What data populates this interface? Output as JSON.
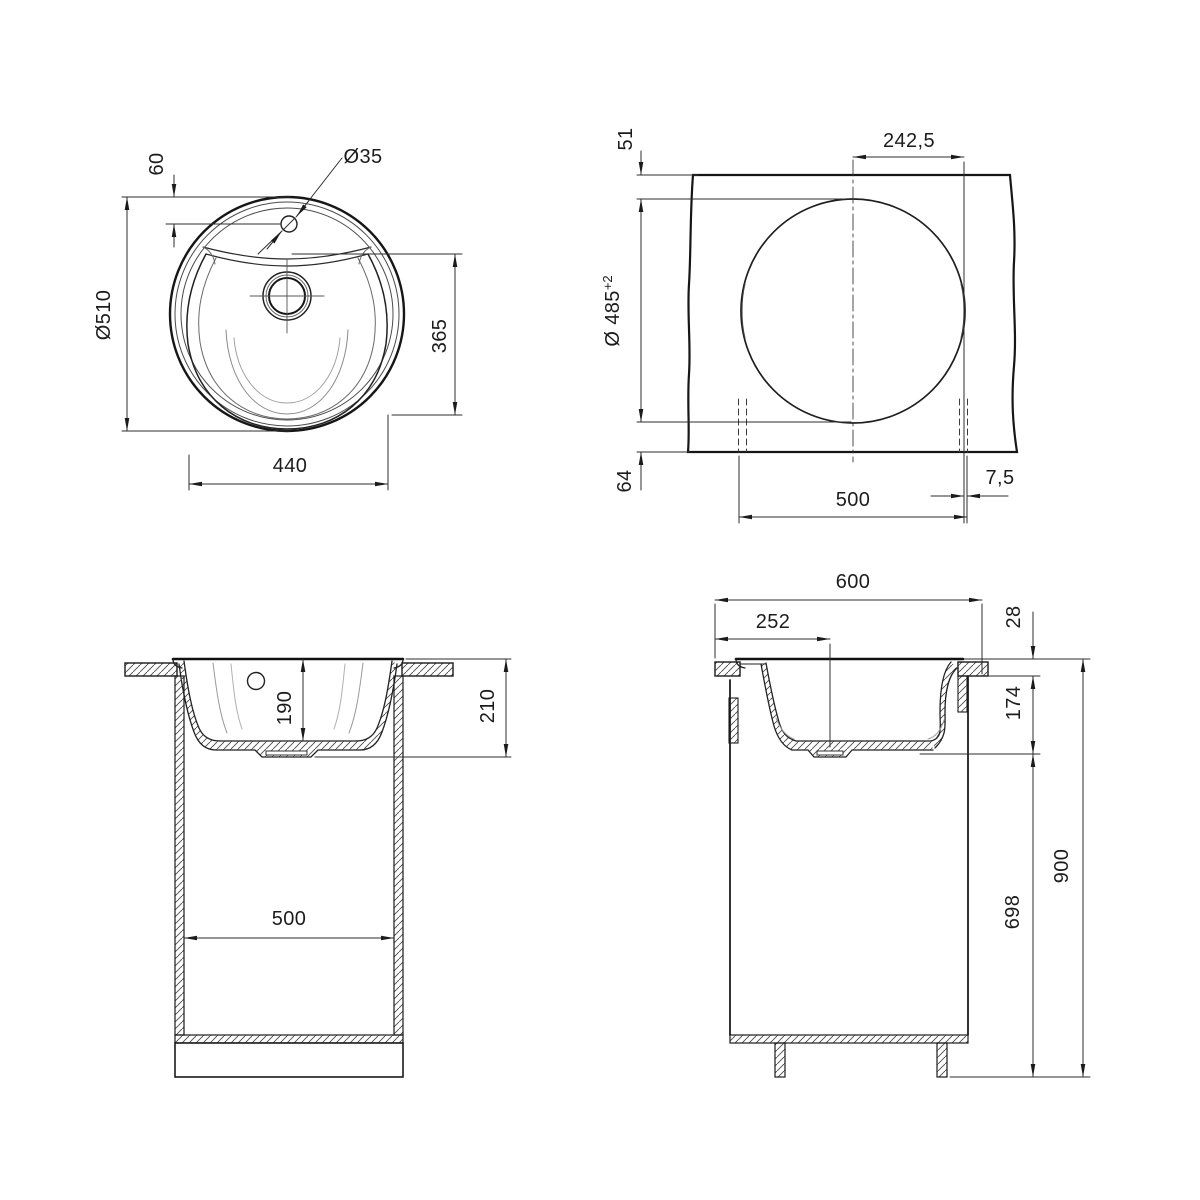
{
  "drawing": {
    "top_view": {
      "faucet_offset": "60",
      "faucet_hole_dia": "Ø35",
      "overall_dia": "Ø510",
      "bowl_length": "365",
      "bowl_width": "440"
    },
    "cutout_view": {
      "edge_to_cutout": "51",
      "center_to_edge": "242,5",
      "cutout_dia": "Ø 485",
      "cutout_tolerance": "+2",
      "cutout_to_front": "64",
      "cabinet_width": "500",
      "side_clearance": "7,5"
    },
    "front_view": {
      "bowl_depth": "190",
      "overall_depth": "210",
      "cabinet_inner_width": "500"
    },
    "side_view": {
      "counter_depth": "600",
      "drain_offset": "252",
      "rim_height": "28",
      "bowl_bottom_offset": "174",
      "underbowl_height": "698",
      "worktop_height": "900"
    }
  }
}
